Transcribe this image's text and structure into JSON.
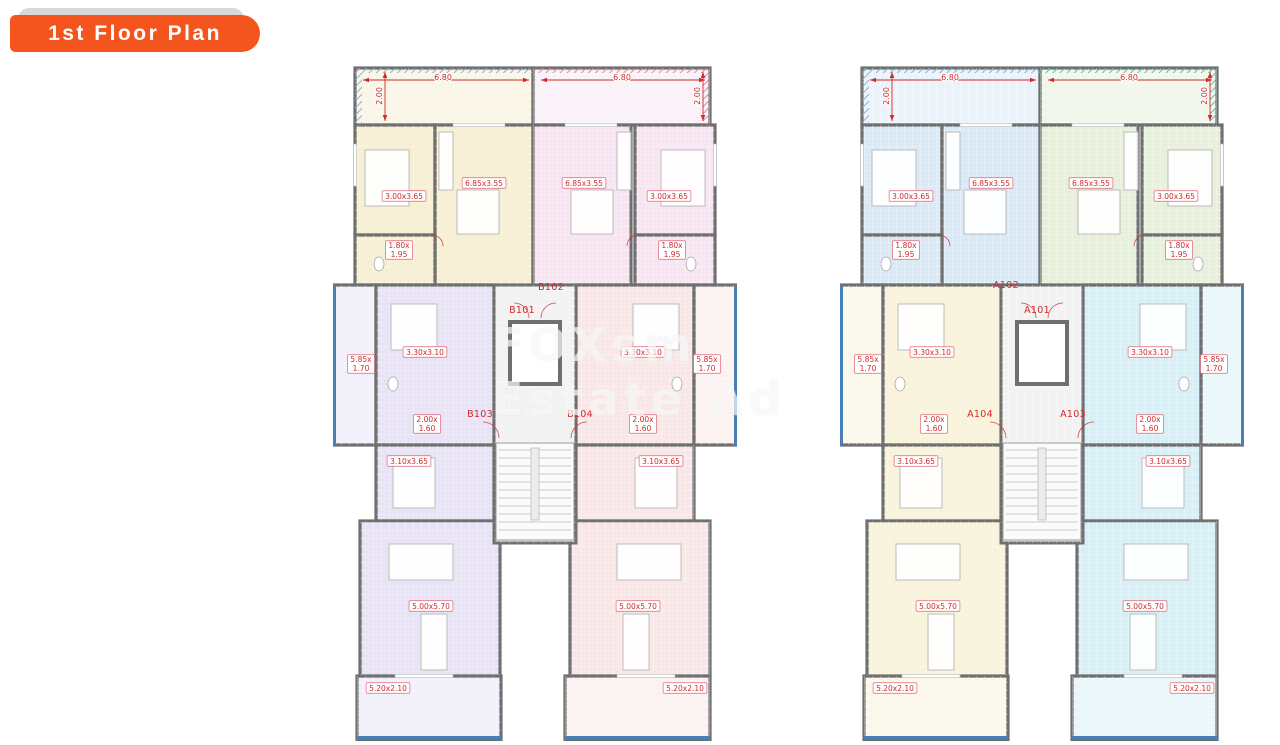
{
  "page": {
    "title": "1st Floor Plan"
  },
  "watermark": {
    "line1": "FOXsm",
    "line2": "Estate Ad"
  },
  "colors": {
    "badge_orange": "#f4551e",
    "badge_gray": "#d8d8d8",
    "wall": "#6f6f6f",
    "dim_red": "#cf2b2b",
    "balcony_rail_blue": "#4a7fb5",
    "hatch_blue": "#7fa3cc",
    "core_fill": "#f2f2f2",
    "background": "#ffffff"
  },
  "shared_dimension_labels": [
    {
      "text": "6.80",
      "x": 110,
      "y": 11,
      "style": "plain"
    },
    {
      "text": "6.80",
      "x": 289,
      "y": 11,
      "style": "plain"
    },
    {
      "text": "2.00",
      "x": 46,
      "y": 30,
      "style": "plain",
      "rotate": true
    },
    {
      "text": "2.00",
      "x": 364,
      "y": 30,
      "style": "plain",
      "rotate": true
    },
    {
      "text": "3.00x3.65",
      "x": 71,
      "y": 130,
      "style": "boxed"
    },
    {
      "text": "3.00x3.65",
      "x": 336,
      "y": 130,
      "style": "boxed"
    },
    {
      "text": "6.85x3.55",
      "x": 151,
      "y": 117,
      "style": "boxed"
    },
    {
      "text": "6.85x3.55",
      "x": 251,
      "y": 117,
      "style": "boxed"
    },
    {
      "text": "1.80x\n1.95",
      "x": 66,
      "y": 184,
      "style": "boxed"
    },
    {
      "text": "1.80x\n1.95",
      "x": 339,
      "y": 184,
      "style": "boxed"
    },
    {
      "text": "3.30x3.10",
      "x": 92,
      "y": 286,
      "style": "boxed"
    },
    {
      "text": "3.30x3.10",
      "x": 310,
      "y": 286,
      "style": "boxed"
    },
    {
      "text": "5.85x\n1.70",
      "x": 28,
      "y": 298,
      "style": "boxed"
    },
    {
      "text": "5.85x\n1.70",
      "x": 374,
      "y": 298,
      "style": "boxed"
    },
    {
      "text": "2.00x\n1.60",
      "x": 94,
      "y": 358,
      "style": "boxed"
    },
    {
      "text": "2.00x\n1.60",
      "x": 310,
      "y": 358,
      "style": "boxed"
    },
    {
      "text": "3.10x3.65",
      "x": 76,
      "y": 395,
      "style": "boxed"
    },
    {
      "text": "3.10x3.65",
      "x": 328,
      "y": 395,
      "style": "boxed"
    },
    {
      "text": "5.00x5.70",
      "x": 98,
      "y": 540,
      "style": "boxed"
    },
    {
      "text": "5.00x5.70",
      "x": 305,
      "y": 540,
      "style": "boxed"
    },
    {
      "text": "5.20x2.10",
      "x": 55,
      "y": 622,
      "style": "boxed"
    },
    {
      "text": "5.20x2.10",
      "x": 352,
      "y": 622,
      "style": "boxed"
    }
  ],
  "buildings": [
    {
      "name": "left-building",
      "block": "B",
      "unit_colors": {
        "top_left": "#f6efd3",
        "top_right": "#f7e6f2",
        "bottom_left": "#e8e3f5",
        "bottom_right": "#f9e7e7"
      },
      "end_hatch_color": "#cf7f93",
      "unit_labels": [
        {
          "id": "B101",
          "x": 189,
          "y": 247
        },
        {
          "id": "B102",
          "x": 218,
          "y": 224
        },
        {
          "id": "B103",
          "x": 147,
          "y": 351
        },
        {
          "id": "B104",
          "x": 247,
          "y": 351
        }
      ]
    },
    {
      "name": "right-building",
      "block": "A",
      "unit_colors": {
        "top_left": "#d9e9f6",
        "top_right": "#e6f0da",
        "bottom_left": "#f8f3d9",
        "bottom_right": "#d7eff6"
      },
      "end_hatch_color": "#4fb0a9",
      "unit_labels": [
        {
          "id": "A102",
          "x": 166,
          "y": 222
        },
        {
          "id": "A101",
          "x": 197,
          "y": 247
        },
        {
          "id": "A104",
          "x": 140,
          "y": 351
        },
        {
          "id": "A103",
          "x": 233,
          "y": 351
        }
      ]
    }
  ]
}
